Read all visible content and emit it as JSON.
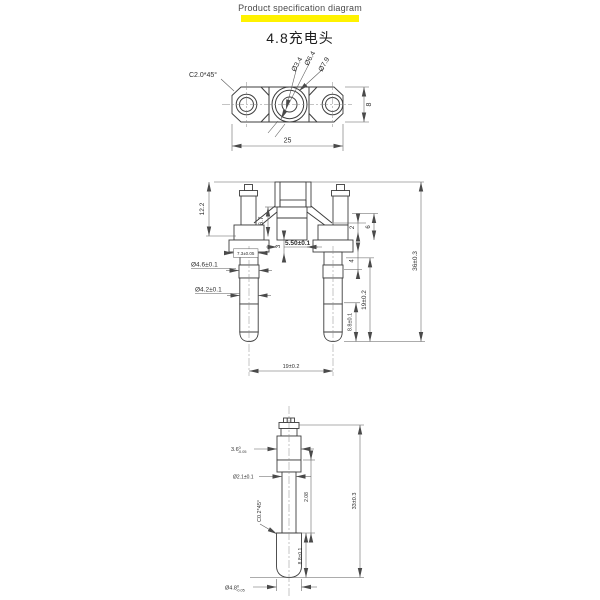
{
  "header": {
    "title": "Product specification diagram",
    "subtitle": "4.8充电头",
    "highlight_color": "#FFF200"
  },
  "views": {
    "top": {
      "labels": {
        "chamfer": "C2.0*45°",
        "dia_small": "Ø3.4",
        "dia_mid": "Ø6.4",
        "dia_large": "Ø7.9",
        "height": "8",
        "width": "25"
      }
    },
    "front": {
      "labels": {
        "left_height": "12.2",
        "mid_height": "6.7",
        "step_height": "3",
        "slot_width": "5.50±0.1",
        "shoulder_width": "7.3±0.05",
        "pin_dia_upper": "Ø4.6±0.1",
        "pin_dia_lower": "Ø4.2±0.1",
        "right_step": "2",
        "right_height": "6",
        "right_mid": "4",
        "pin_length": "19±0.2",
        "tip_length": "8.8±0.1",
        "total_height": "36±0.3",
        "pin_pitch": "19±0.2"
      }
    },
    "detail": {
      "labels": {
        "body_width_val": "3.6",
        "body_width_tol_up": "0",
        "body_width_tol_dn": "-0.05",
        "shaft_dia": "Ø2.1±0.1",
        "mid_length": "2.08",
        "chamfer": "C0.2*45°",
        "tip_length": "8.8±0.1",
        "total_length": "33±0.3",
        "tip_dia_val": "Ø4.8",
        "tip_dia_tol_up": "0",
        "tip_dia_tol_dn": "-0.05"
      }
    }
  }
}
